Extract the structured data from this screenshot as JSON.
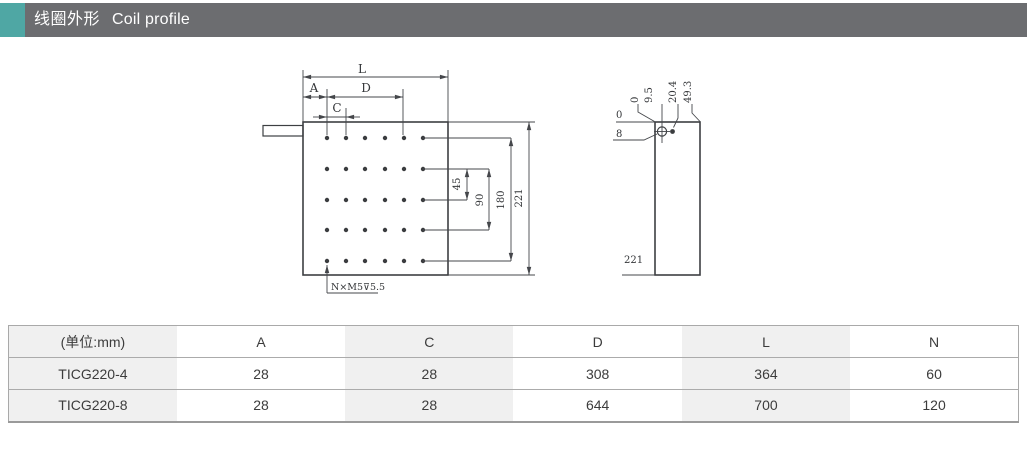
{
  "header": {
    "title_zh": "线圈外形",
    "title_en": "Coil profile",
    "colors": {
      "accent": "#4fa7a4",
      "bar": "#6c6d70"
    }
  },
  "drawing": {
    "front_view": {
      "dim_length": "L",
      "dim_a": "A",
      "dim_c": "C",
      "dim_d": "D",
      "dim_45": "45",
      "dim_90": "90",
      "dim_180": "180",
      "dim_221": "221",
      "hole_note": "N×M5⊽5.5"
    },
    "side_view": {
      "ref_zero_top": "0",
      "dim_9_5": "9.5",
      "dim_20_4": "20.4",
      "dim_49_3": "49.3",
      "ref_zero_left": "0",
      "dim_8": "8",
      "dim_221": "221"
    }
  },
  "table": {
    "unit_header": "(单位:mm)",
    "columns": [
      "A",
      "C",
      "D",
      "L",
      "N"
    ],
    "rows": [
      {
        "model": "TICG220-4",
        "A": "28",
        "C": "28",
        "D": "308",
        "L": "364",
        "N": "60"
      },
      {
        "model": "TICG220-8",
        "A": "28",
        "C": "28",
        "D": "644",
        "L": "700",
        "N": "120"
      }
    ]
  }
}
